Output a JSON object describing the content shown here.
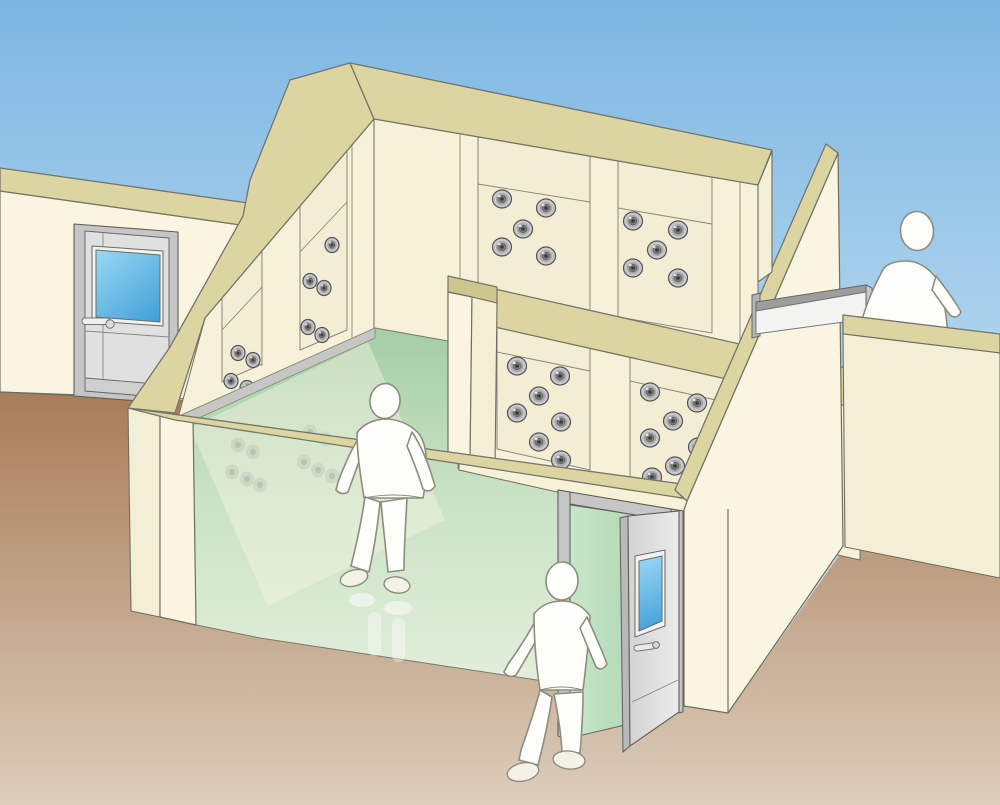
{
  "scene": {
    "title": "Air shower cleanroom cutaway illustration",
    "rooms": [
      "air-shower-chamber-front",
      "air-shower-chamber-rear"
    ],
    "figure_count": 3,
    "door_count": 3,
    "nozzle_total": 35
  },
  "colors": {
    "sky_top": "#7db6e2",
    "sky_low": "#c6e2f2",
    "ground_top": "#a87c58",
    "ground_low": "#dccdbb",
    "khaki": "#dcd5a2",
    "khaki_side": "#cdc68f",
    "band_stroke": "#75756a",
    "outline": "#6e6e60",
    "cream_outer": "#f9f5e1",
    "cream_face2": "#f3eed6",
    "cream_inner": "#f6f1d9",
    "wall_shade": "#eee8cf",
    "panel": "#f2edd3",
    "panel_stroke": "#8a887b",
    "baseboard": "#c6c6c2",
    "floor_far": "#a3cea6",
    "floor_near": "#e3efdc",
    "refl_wash": "#f7f3e2",
    "nozzle_outer": "#c8c8c8",
    "nozzle_mid": "#a6a6a6",
    "nozzle_inner": "#7a7a7a",
    "nozzle_hole": "#3d3d3d",
    "nozzle_edge": "#55525a",
    "door_frame": "#c6c6c6",
    "door_leaf": "#e0e0e0",
    "door_leaf_dark": "#b9b9b9",
    "door_white": "#f2f2f0",
    "metal_dark": "#9d9d9d",
    "win_top": "#9ad8f4",
    "win_bot": "#3f9fd7",
    "green_door_top": "#c8e6ca",
    "green_door_bot": "#a4d2a8",
    "figure_fill": "#fdfdf9",
    "figure_stroke": "#8d8d82",
    "shoe": "#f4f2e6"
  },
  "walls": {
    "back_left": {
      "nozzle_rx": 7,
      "nozzle_ry": 7.5,
      "panels": [
        {
          "nozzles": [
            [
              332,
              245
            ],
            [
              310,
              281
            ],
            [
              324,
              288
            ],
            [
              308,
              327
            ],
            [
              322,
              335
            ],
            [
              308,
              371
            ],
            [
              322,
              379
            ]
          ]
        },
        {
          "nozzles": [
            [
              238,
              353
            ],
            [
              253,
              360
            ],
            [
              231,
              381
            ],
            [
              247,
              388
            ]
          ]
        }
      ]
    },
    "back_right": {
      "nozzle_rx": 9.5,
      "nozzle_ry": 9,
      "panels": [
        {
          "nozzles": [
            [
              502,
              199
            ],
            [
              546,
              208
            ],
            [
              523,
              229
            ],
            [
              502,
              247
            ],
            [
              546,
              256
            ]
          ]
        },
        {
          "nozzles": [
            [
              633,
              221
            ],
            [
              678,
              230
            ],
            [
              657,
              250
            ],
            [
              633,
              268
            ],
            [
              678,
              278
            ]
          ]
        }
      ]
    },
    "partition": {
      "nozzle_rx": 9.5,
      "nozzle_ry": 9,
      "panels": [
        {
          "nozzles": [
            [
              517,
              366
            ],
            [
              560,
              376
            ],
            [
              539,
              396
            ],
            [
              517,
              413
            ],
            [
              561,
              422
            ],
            [
              539,
              442
            ],
            [
              561,
              460
            ]
          ]
        },
        {
          "nozzles": [
            [
              650,
              392
            ],
            [
              697,
              403
            ],
            [
              673,
              421
            ],
            [
              650,
              438
            ],
            [
              698,
              447
            ],
            [
              675,
              466
            ],
            [
              652,
              477
            ]
          ]
        }
      ]
    }
  },
  "floor_reflection": {
    "opacity": 0.22,
    "nozzles": [
      [
        238,
        445
      ],
      [
        253,
        452
      ],
      [
        232,
        472
      ],
      [
        247,
        479
      ],
      [
        260,
        485
      ],
      [
        310,
        432
      ],
      [
        325,
        439
      ],
      [
        304,
        462
      ],
      [
        318,
        470
      ],
      [
        332,
        476
      ]
    ]
  },
  "figures": [
    {
      "id": "worker-walking-inside",
      "pose": "walking away inside chamber"
    },
    {
      "id": "worker-entering-door",
      "pose": "entering through open entrance door"
    },
    {
      "id": "worker-exiting-far-side",
      "pose": "leaving past far exit door"
    }
  ]
}
